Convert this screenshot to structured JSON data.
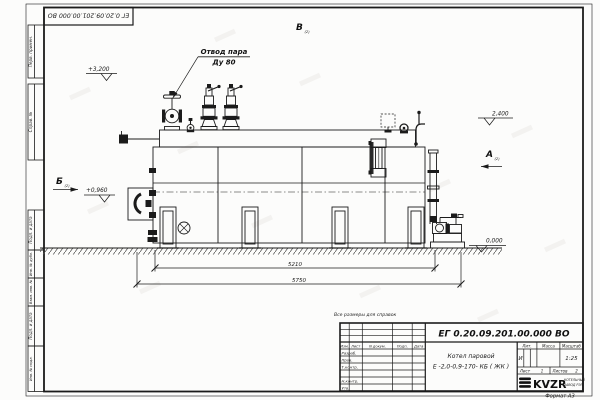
{
  "colors": {
    "ink": "#1b1b1b",
    "paper": "#fcfcfb",
    "hatch": "#555555"
  },
  "sheet": {
    "stamp_top_doc_number": "ЕГ 0.20.09.201.00.000  ВО",
    "note": "Все размеры для справок",
    "format_label": "Формат А3",
    "margin_labels": [
      "Перв. примен.",
      "Справ. №",
      "Подп. и дата",
      "Инв. № дубл.",
      "Взам. инв. №",
      "Подп. и дата",
      "Инв. № подл."
    ]
  },
  "drawing": {
    "steam_label_1": "Отвод пара",
    "steam_label_2": "Ду 80",
    "elev_top": "+3,200",
    "elev_right": "2,400",
    "elev_left": "+0,960",
    "elev_zero": "0,000",
    "dim_inner": "5210",
    "dim_overall": "5750",
    "view_b": "Б",
    "view_v": "В",
    "view_a": "А",
    "view_idx": "(2)"
  },
  "title_block": {
    "doc_number": "ЕГ 0.20.09.201.00.000  ВО",
    "name_line1": "Котел паровой",
    "name_line2": "Е -2,0-0,9-170- КБ ( ЖК )",
    "col_izm": "Изм.",
    "col_list": "Лист",
    "col_doc": "N докум.",
    "col_podp": "Подп.",
    "col_data": "Дата",
    "rows": [
      "Разраб.",
      "Пров.",
      "Т.контр.",
      "Н.контр.",
      "Утв."
    ],
    "lit_label": "Лит.",
    "mass_label": "Масса",
    "scale_label": "Масштаб",
    "lit_value": "И",
    "scale_value": "1:25",
    "sheet_label": "Лист",
    "sheet_value": "1",
    "sheets_label": "Листов",
    "sheets_value": "2",
    "logo_text": "KVZR",
    "logo_sub1": "КОТЕЛЬНЫЙ",
    "logo_sub2": "ЗАВОД РЭП"
  }
}
